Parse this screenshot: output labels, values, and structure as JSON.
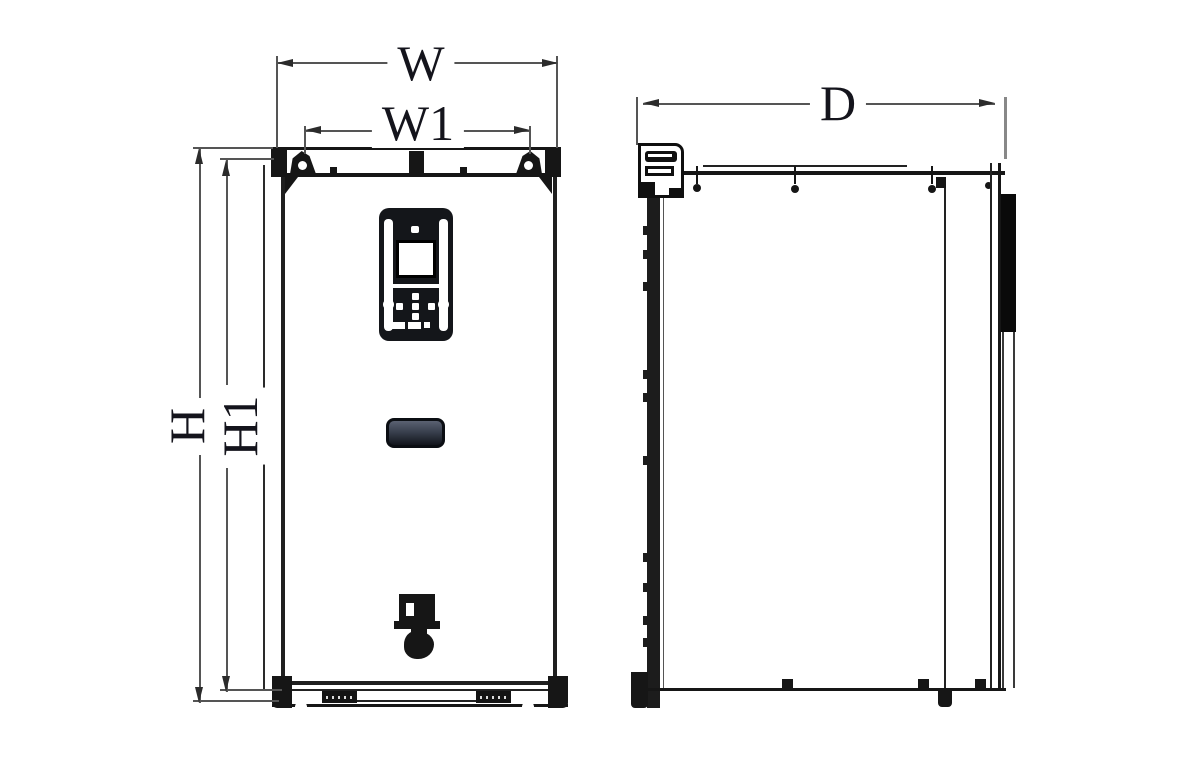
{
  "dimensions": {
    "width": {
      "label": "W"
    },
    "mount_width": {
      "label": "W1"
    },
    "depth": {
      "label": "D"
    },
    "height": {
      "label": "H"
    },
    "mount_height": {
      "label": "H1"
    }
  },
  "colors": {
    "background": "#ffffff",
    "outline": "#161616",
    "dimension_line": "#555555",
    "arrow": "#2b2b2b",
    "label_text": "#14141c",
    "keypad_body": "#14161a",
    "lcd_screen": "#ffffff",
    "nameplate_top": "#5a6172",
    "nameplate_bottom": "#12151c"
  }
}
